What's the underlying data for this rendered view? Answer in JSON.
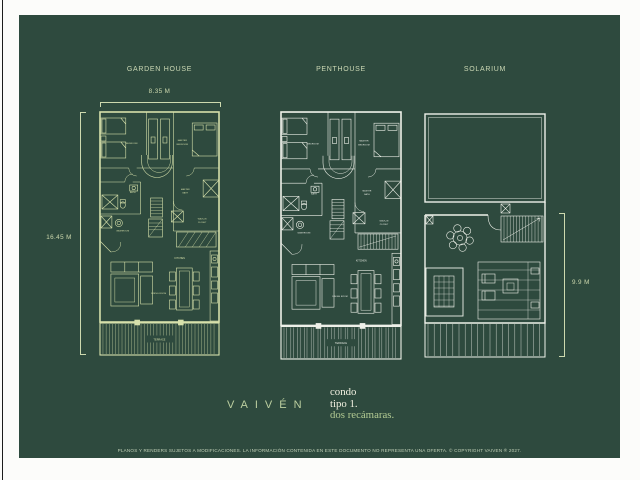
{
  "colors": {
    "panel_background": "#2e4a3e",
    "garden_house_line": "#d7e1ab",
    "white_line": "#eef1e9",
    "title_text": "#cbd8b4",
    "dimension_text": "#cdd9ae",
    "logo_text": "#bccfa0",
    "tagline_white": "#f3f1e2",
    "tagline_green": "#b3cb93",
    "disclaimer_text": "#c2d1b8"
  },
  "plans": {
    "garden_house": {
      "title": "GARDEN HOUSE",
      "width_dimension": "8.35 M",
      "height_dimension": "16.45 M"
    },
    "penthouse": {
      "title": "PENTHOUSE"
    },
    "solarium": {
      "title": "SOLARIUM",
      "height_dimension": "9.9 M"
    }
  },
  "room_labels": {
    "bedroom": "BEDROOM",
    "master_bedroom_line1": "MASTER",
    "master_bedroom_line2": "BEDROOM",
    "bath": "BATH",
    "washroom": "WASHROOM",
    "master_bath_line1": "MASTER",
    "master_bath_line2": "BATH",
    "walk_in_closet_line1": "WALK-IN",
    "walk_in_closet_line2": "CLOSET",
    "dining_room": "DINING ROOM",
    "kitchen": "KITCHEN",
    "terrace": "TERRACE"
  },
  "branding": {
    "logo": "VAIVÉN",
    "tagline": [
      "condo",
      "tipo 1.",
      "dos recámaras."
    ]
  },
  "footer": {
    "disclaimer": "PLANOS Y RENDERS SUJETOS A MODIFICACIONES. LA INFORMACIÓN CONTENIDA EN ESTE DOCUMENTO NO REPRESENTA UNA OFERTA. © COPYRIGHT VAIVEN ® 2027."
  }
}
